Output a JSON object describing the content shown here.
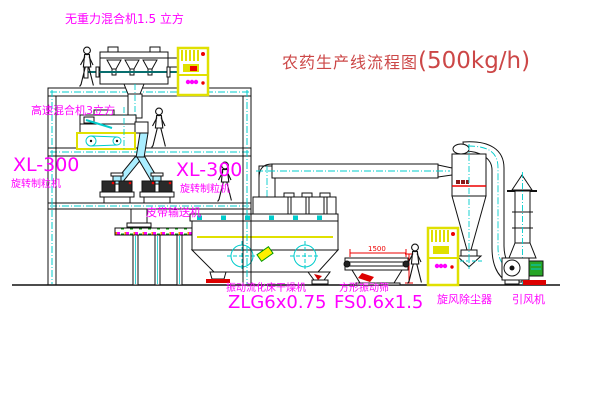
{
  "title": {
    "text": "农药生产线流程图",
    "capacity": "(500kg/h)"
  },
  "equipment": {
    "gravity_mixer": {
      "label": "无重力混合机1.5 立方"
    },
    "high_speed_mixer": {
      "label": "高速混合机3立方"
    },
    "granulator_left": {
      "model": "XL-300",
      "name": "旋转制粒机"
    },
    "granulator_right": {
      "model": "XL-300",
      "name": "旋转制粒机"
    },
    "belt_conveyor": {
      "name": "皮带输送机"
    },
    "fluid_bed_dryer": {
      "name": "振动流化床干燥机",
      "model": "ZLG6x0.75"
    },
    "vibrating_sieve": {
      "name": "方形振动筛",
      "model": "FS0.6x1.5",
      "width_dim": "1500"
    },
    "cyclone": {
      "name": "旋风除尘器"
    },
    "draft_fan": {
      "name": "引风机"
    }
  },
  "colors": {
    "label_magenta": "#ff00ff",
    "title_red": "#cc4747",
    "dimension_red": "#ee0000",
    "line_black": "#1a1a1a",
    "pipe_cyan": "#00cccc",
    "cabinet_yellow": "#e6e600"
  }
}
